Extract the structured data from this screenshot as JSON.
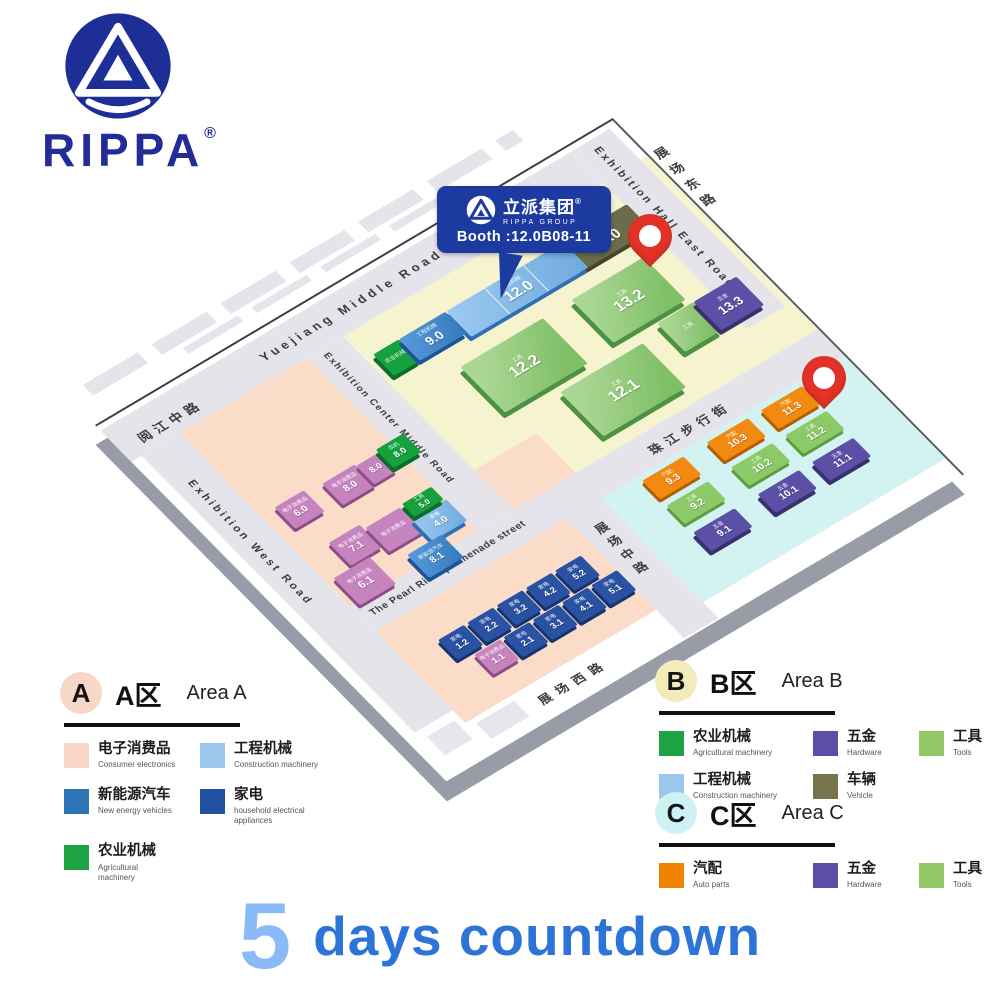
{
  "logo": {
    "brand": "RIPPA",
    "registered": "®"
  },
  "callout": {
    "company_cn": "立派集团",
    "company_en": "RIPPA GROUP",
    "registered": "®",
    "booth_label": "Booth :12.0B08-11"
  },
  "map": {
    "roads": {
      "yuejiang_en": "Yuejiang Middle Road",
      "yuejiang_cn": "阅江中路",
      "east_hall_en": "Exhibition Hall East Road",
      "east_cn": "展场东路",
      "center_en": "Exhibition Center Middle Road",
      "west_en": "Exhibition West Road",
      "promenade_en": "The Pearl River promenade street",
      "middle_cn": "展场中路",
      "west_cn": "展场西路",
      "pearl_pedestrian_cn": "珠江步行街"
    },
    "halls": [
      {
        "num": "13.0",
        "cat": "车辆",
        "color": "olive"
      },
      {
        "num": "12.0",
        "cat": "工程机械",
        "color": "lightblue"
      },
      {
        "num": "",
        "cat": "农业机械",
        "color": "green"
      },
      {
        "num": "9.0",
        "cat": "工程机械",
        "color": "blue"
      },
      {
        "num": "13.2",
        "cat": "工具",
        "color": "greenbig"
      },
      {
        "num": "12.2",
        "cat": "工具",
        "color": "greenbig"
      },
      {
        "num": "12.1",
        "cat": "工具",
        "color": "greenbig"
      },
      {
        "num": "",
        "cat": "工具",
        "color": "greenbig"
      },
      {
        "num": "13.3",
        "cat": "五金",
        "color": "purple"
      },
      {
        "num": "8.0",
        "cat": "电子消费品",
        "color": "mauve"
      },
      {
        "num": "8.0",
        "cat": "",
        "color": "mauve"
      },
      {
        "num": "8.0",
        "cat": "农机",
        "color": "green"
      },
      {
        "num": "6.0",
        "cat": "电子消费品",
        "color": "mauve"
      },
      {
        "num": "7.1",
        "cat": "电子消费品",
        "color": "mauve"
      },
      {
        "num": "",
        "cat": "电子消费品",
        "color": "mauve"
      },
      {
        "num": "6.1",
        "cat": "电子消费品",
        "color": "mauve"
      },
      {
        "num": "4.0",
        "cat": "家电",
        "color": "lightblue"
      },
      {
        "num": "8.1",
        "cat": "新能源汽车",
        "color": "blue"
      },
      {
        "num": "5.0",
        "cat": "工具",
        "color": "green"
      },
      {
        "num": "1.2",
        "cat": "家电",
        "color": "navy"
      },
      {
        "num": "2.2",
        "cat": "家电",
        "color": "navy"
      },
      {
        "num": "3.2",
        "cat": "家电",
        "color": "navy"
      },
      {
        "num": "4.2",
        "cat": "家电",
        "color": "navy"
      },
      {
        "num": "5.2",
        "cat": "家电",
        "color": "navy"
      },
      {
        "num": "1.1",
        "cat": "电子消费品",
        "color": "mauve"
      },
      {
        "num": "2.1",
        "cat": "家电",
        "color": "navy"
      },
      {
        "num": "3.1",
        "cat": "家电",
        "color": "navy"
      },
      {
        "num": "4.1",
        "cat": "家电",
        "color": "navy"
      },
      {
        "num": "5.1",
        "cat": "家电",
        "color": "navy"
      },
      {
        "num": "9.3",
        "cat": "汽配",
        "color": "orange"
      },
      {
        "num": "10.3",
        "cat": "汽配",
        "color": "orange"
      },
      {
        "num": "11.3",
        "cat": "汽配",
        "color": "orange"
      },
      {
        "num": "9.2",
        "cat": "工具",
        "color": "lightgreen"
      },
      {
        "num": "10.2",
        "cat": "工具",
        "color": "lightgreen"
      },
      {
        "num": "11.2",
        "cat": "工具",
        "color": "lightgreen"
      },
      {
        "num": "9.1",
        "cat": "五金",
        "color": "purple"
      },
      {
        "num": "10.1",
        "cat": "五金",
        "color": "purple"
      },
      {
        "num": "11.1",
        "cat": "五金",
        "color": "purple"
      }
    ]
  },
  "legend_a": {
    "circle": "A",
    "circle_color": "#f8d7c8",
    "title_cn": "A区",
    "title_en": "Area A",
    "items": [
      {
        "cn": "电子消费品",
        "en": "Consumer electronics",
        "color": "#f8d7c8"
      },
      {
        "cn": "工程机械",
        "en": "Construction machinery",
        "color": "#9cc6ec"
      },
      {
        "cn": "新能源汽车",
        "en": "New energy vehicles",
        "color": "#2e75b6"
      },
      {
        "cn": "家电",
        "en": "household electrical appliances",
        "color": "#2450a4"
      },
      {
        "cn": "农业机械",
        "en": "Agricultural machinery",
        "color": "#1ea344"
      }
    ]
  },
  "legend_b": {
    "circle": "B",
    "circle_color": "#f3ecba",
    "title_cn": "B区",
    "title_en": "Area B",
    "items": [
      {
        "cn": "农业机械",
        "en": "Agricultural machinery",
        "color": "#1ea344"
      },
      {
        "cn": "五金",
        "en": "Hardware",
        "color": "#5b4ea6"
      },
      {
        "cn": "工具",
        "en": "Tools",
        "color": "#92c865"
      },
      {
        "cn": "工程机械",
        "en": "Construction machinery",
        "color": "#9cc6ec"
      },
      {
        "cn": "车辆",
        "en": "Vehicle",
        "color": "#75744e"
      }
    ]
  },
  "legend_c": {
    "circle": "C",
    "circle_color": "#cdf1f4",
    "title_cn": "C区",
    "title_en": "Area C",
    "items": [
      {
        "cn": "汽配",
        "en": "Auto parts",
        "color": "#f08300"
      },
      {
        "cn": "五金",
        "en": "Hardware",
        "color": "#5b4ea6"
      },
      {
        "cn": "工具",
        "en": "Tools",
        "color": "#92c865"
      }
    ]
  },
  "countdown": {
    "number": "5",
    "text": "days countdown"
  },
  "colors": {
    "brand_navy": "#1c3aa0",
    "pin_red": "#e23227",
    "area_a_bg": "#fadcc9",
    "area_b_bg": "#f6f3cf",
    "area_c_bg": "#d2f3f2",
    "countdown_blue": "#2d74d9",
    "countdown_light": "#8abaf7"
  }
}
